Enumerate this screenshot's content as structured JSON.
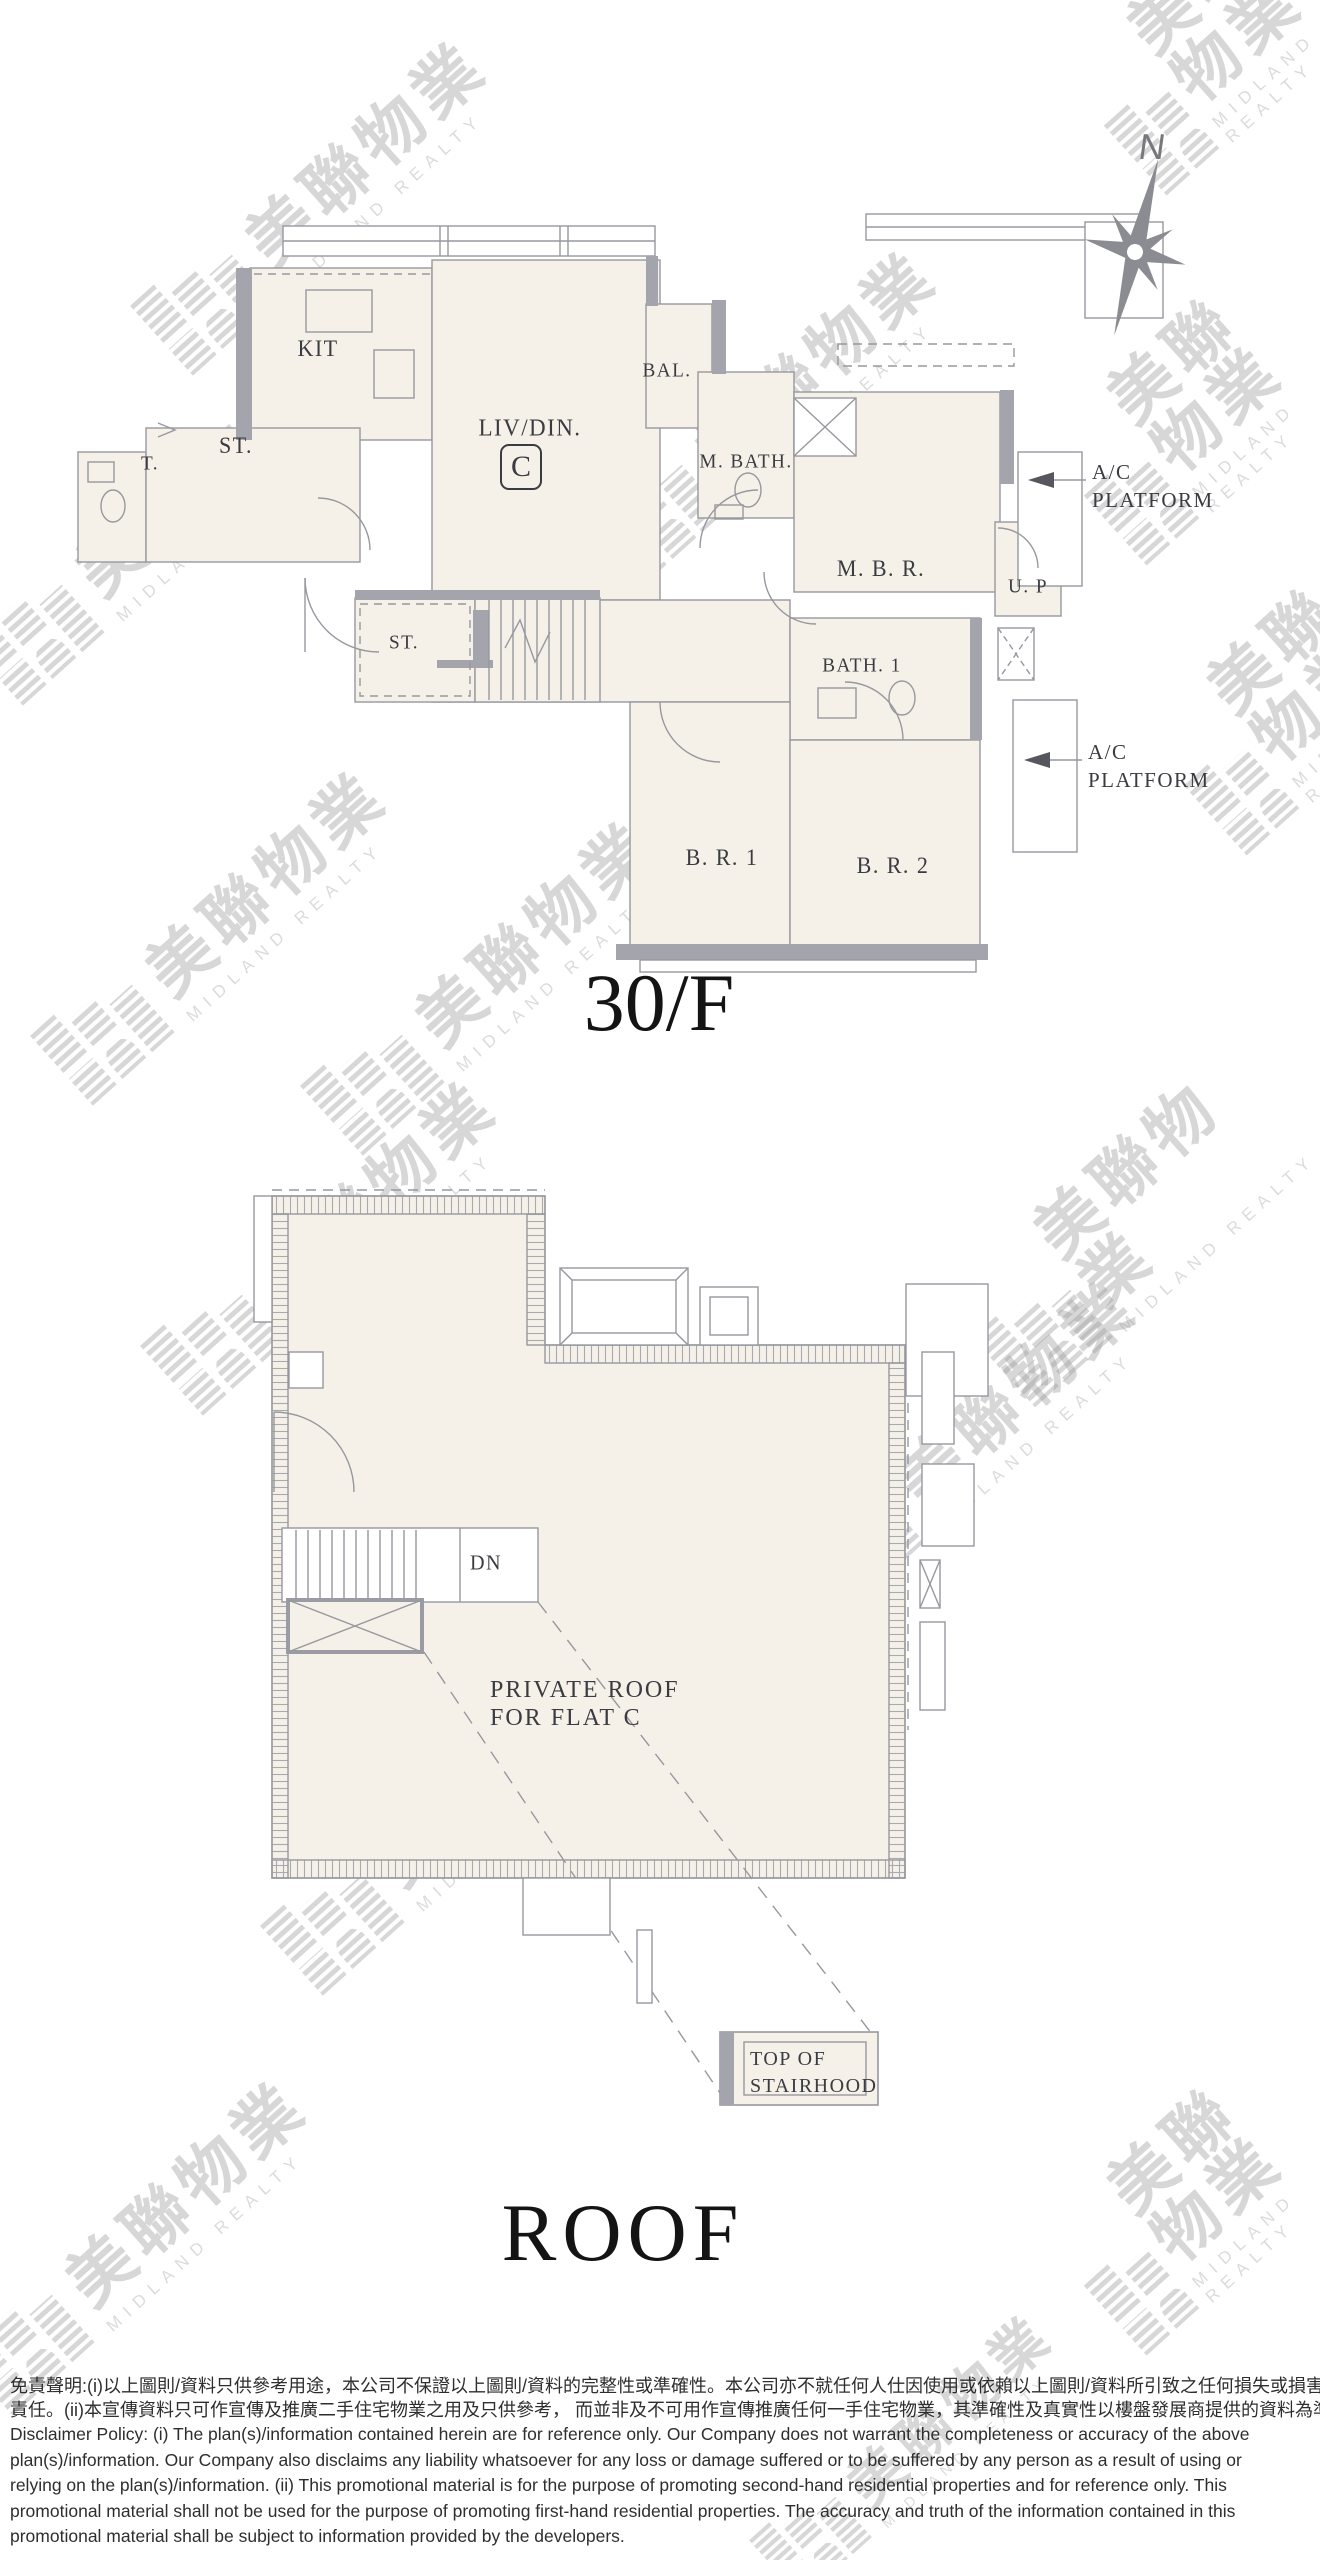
{
  "watermark": {
    "cn": "美聯物業",
    "en": "MIDLAND REALTY"
  },
  "compass": {
    "north_label": "N"
  },
  "plan_30f": {
    "caption": "30/F",
    "labels": {
      "kit": "KIT",
      "store_upper": "ST.",
      "toilet": "T.",
      "living_dining": "LIV/DIN.",
      "flat_marker": "C",
      "balcony": "BAL.",
      "master_bath": "M. BATH.",
      "master_bedroom": "M. B. R.",
      "utility_platform": "U. P",
      "bath1": "BATH. 1",
      "store_lower": "ST.",
      "bedroom1": "B. R. 1",
      "bedroom2": "B. R. 2",
      "ac_platform_line1": "A/C",
      "ac_platform_line2": "PLATFORM"
    }
  },
  "plan_roof": {
    "caption": "ROOF",
    "labels": {
      "down": "DN",
      "private_roof_line1": "PRIVATE ROOF",
      "private_roof_line2": "FOR FLAT C",
      "stairhood_line1": "TOP OF",
      "stairhood_line2": "STAIRHOOD"
    }
  },
  "disclaimer": {
    "lines": [
      "免責聲明:(i)以上圖則/資料只供參考用途，本公司不保證以上圖則/資料的完整性或準確性。本公司亦不就任何人仕因使用或依賴以上圖則/資料所引致之任何損失或損害負上任何",
      "責任。(ii)本宣傳資料只可作宣傳及推廣二手住宅物業之用及只供參考， 而並非及不可用作宣傳推廣任何一手住宅物業，其準確性及真實性以樓盤發展商提供的資料為準。",
      "Disclaimer Policy: (i) The plan(s)/information contained herein are for reference only. Our Company does not warrant the completeness or accuracy of the above",
      "plan(s)/information. Our Company also disclaims any liability whatsoever for any loss or damage suffered or to be suffered by any person as a result of using or",
      "relying on the plan(s)/information. (ii) This promotional material is for the purpose of promoting second-hand residential properties and for reference only. This",
      "promotional material shall not be used for the purpose of promoting first-hand residential properties. The accuracy and truth of the information contained in this",
      "promotional material shall be subject to information provided by the developers."
    ]
  }
}
